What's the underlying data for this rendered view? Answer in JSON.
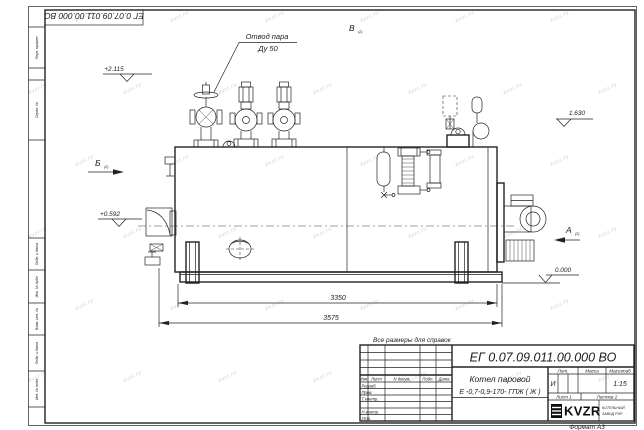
{
  "sheet": {
    "top_stamp": "ЕГ 0.07.09.011.00.000  ВО",
    "format_label": "Формат А3",
    "note": "Все размеры для справок",
    "side_labels": [
      "Перв. примен.",
      "Справ. №",
      "Подп. и дата",
      "Инв. № дубл.",
      "Взам. инв. №",
      "Подп. и дата",
      "Инв. № подл."
    ]
  },
  "watermark": {
    "text": "kvzr.ru",
    "color": "#a9a9a9"
  },
  "drawing": {
    "callout_steam_line1": "Отвод пара",
    "callout_steam_line2": "Ду 50",
    "view_top_label": "В",
    "view_top_ref": "(2)",
    "view_left_label": "Б",
    "view_left_ref": "(2)",
    "view_right_label": "А",
    "view_right_ref": "(2)",
    "elev_top_left": "+2.115",
    "elev_mid_left": "+0.592",
    "elev_right": "1.630",
    "elev_zero": "0.000",
    "dim_inner": "3350",
    "dim_outer": "3575"
  },
  "title_block": {
    "designation": "ЕГ 0.07.09.011.00.000  ВО",
    "name_line1": "Котел паровой",
    "name_line2": "Е -0,7-0,9-170- ГПЖ ( Ж )",
    "col_izm": "Изм.",
    "col_list": "Лист",
    "col_ndoc": "N докум.",
    "col_podp": "Подп.",
    "col_data": "Дата",
    "rows": [
      "Разраб.",
      "Пров.",
      "Т.контр.",
      "",
      "Н.контр.",
      "Утв."
    ],
    "lit_header": "Лит.",
    "mass_header": "Масса",
    "scale_header": "Масштаб",
    "lit_value": "И",
    "scale_value": "1:15",
    "sheet_info": "Лист 1",
    "sheets_info": "Листов 2",
    "logo_text": "KVZR",
    "company_line1": "КОТЕЛЬНЫЙ",
    "company_line2": "ЗАВОД РЭР"
  }
}
